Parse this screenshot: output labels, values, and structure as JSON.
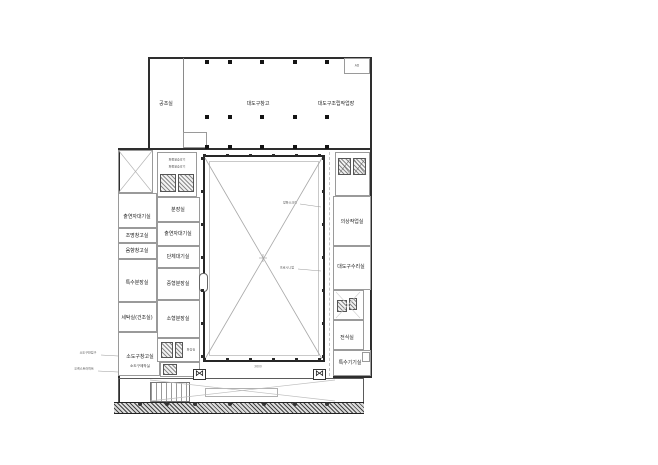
{
  "rooms": {
    "hvac": "공조실",
    "hall_storage": "대도구창고",
    "hall_workshop": "대도구조립작업장",
    "corner_shaft": "AD",
    "left_waiting": "출연자대기실",
    "left_light_storage": "조명창고실",
    "left_sound_storage": "음향창고실",
    "left_special_makeup": "특수분장실",
    "left_laundry": "세탁실(건조실)",
    "left_prop_storage": "소도구창고실",
    "left_prop_workshop": "소도구제작실",
    "mid_makeup": "분장실",
    "mid_waiting_a": "출연자대기실",
    "mid_waiting_b": "단체대기실",
    "mid_makeup_m": "중형분장실",
    "mid_makeup_s": "소형분장실",
    "mid_toilet": "화장실",
    "right_costume": "의상작업실",
    "right_prop_repair": "대도구수리실",
    "right_elec": "전식실",
    "right_special_equip": "특수기기실",
    "freight_elevator": "화물용승강기"
  },
  "annotations": {
    "fire_screen": "방화스크린",
    "proscenium": "프로시니엄",
    "dock": "소도구반입구",
    "pit": "오케스트라피트",
    "dim": "3600"
  },
  "icons": {
    "stage_lift": "⋈"
  }
}
